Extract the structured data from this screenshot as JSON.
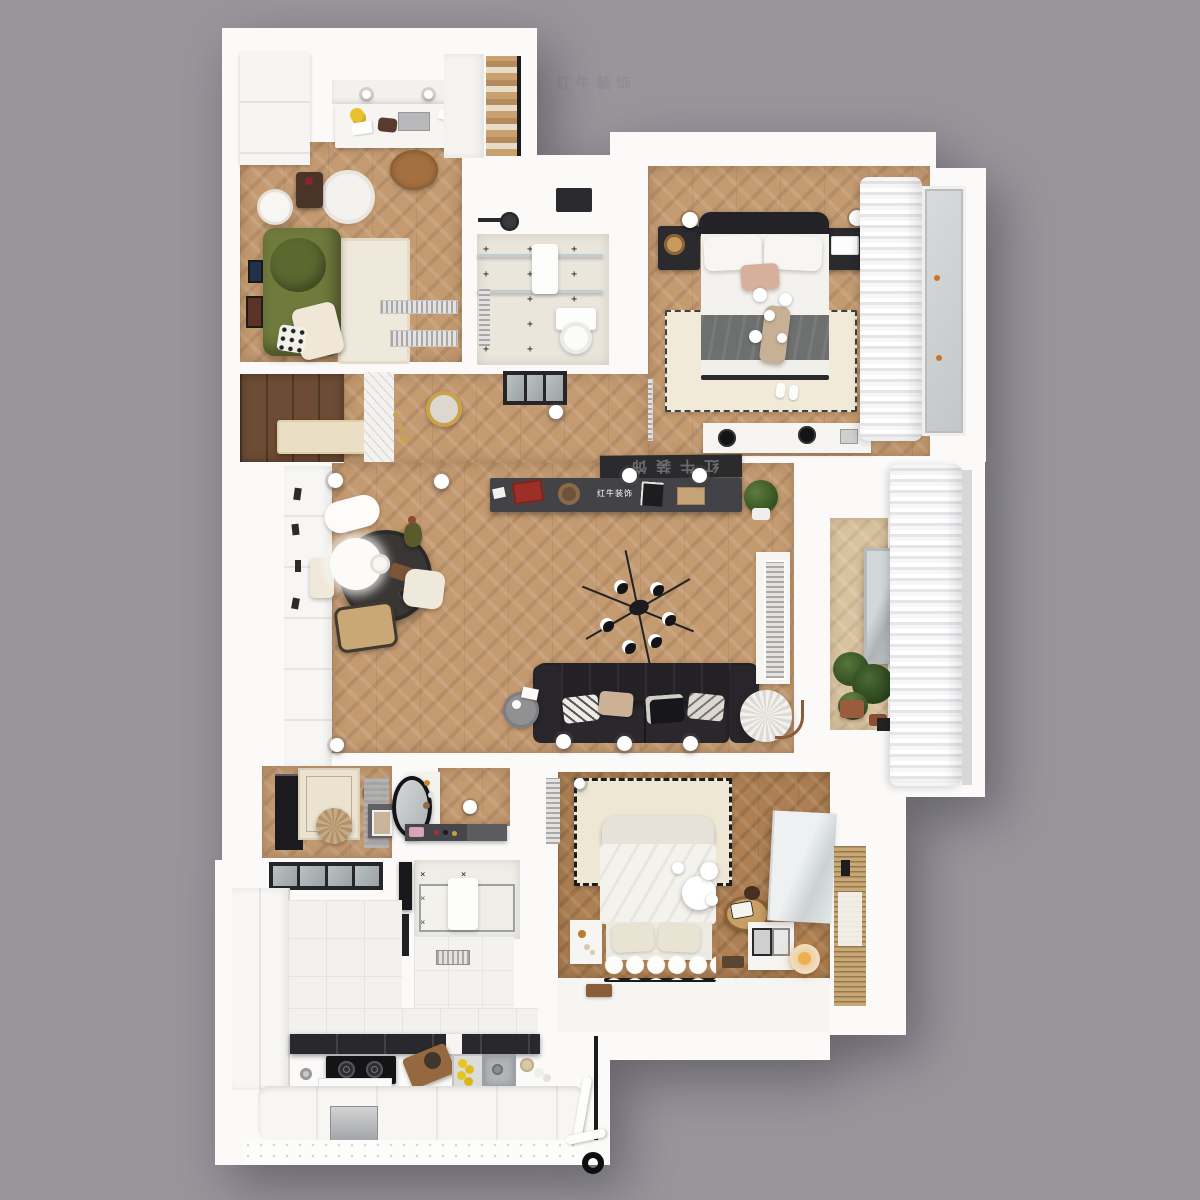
{
  "scene": {
    "background_color": "#98959b",
    "watermark_text": "红牛装饰",
    "view": "top-down 3d floorplan render"
  },
  "branding": {
    "console_logo_text": "红牛装饰",
    "screen_logo_text": "红牛装饰",
    "logo_color": "#ffffff"
  },
  "patterns": {
    "plus": "+",
    "cross": "×"
  },
  "palette": {
    "background": "#98959b",
    "wall_white": "#fbfaf9",
    "wood_mid": "#c49a70",
    "wood_light": "#d9c29e",
    "wood_dark": "#ad7f52",
    "plank_dark": "#6d4c35",
    "tile_cream": "#eae6dc",
    "tile_white": "#f3f2f0",
    "sofa_green": "#6f7a3c",
    "sofa_black": "#232126",
    "console_dark": "#434347",
    "accent_red": "#9c2f28",
    "lemon_yellow": "#e6c51e",
    "plant_green": "#4a6a33",
    "terracotta": "#9a5c3c",
    "brass_gold": "#c9a24a",
    "blanket_gray": "#6e706f",
    "pillow_pink": "#d6b09a"
  },
  "rooms": [
    {
      "id": "office",
      "label": "study room",
      "furniture": [
        "white wardrobe",
        "desk with laptop",
        "sunflowers",
        "leather desk chair",
        "round pouf table",
        "dark side table",
        "arc floor lamp",
        "green velvet sofa",
        "cream rug",
        "wall frames",
        "floor vents"
      ]
    },
    {
      "id": "closet",
      "label": "walk-in closet",
      "furniture": [
        "wood shelving",
        "white cabinet"
      ]
    },
    {
      "id": "bath-top",
      "label": "bathroom",
      "furniture": [
        "skylight",
        "shower head",
        "glass partition",
        "bath mat",
        "toilet",
        "plus-tile floor"
      ]
    },
    {
      "id": "bed-master",
      "label": "master bedroom",
      "furniture": [
        "black tufted bed",
        "white pillows",
        "pink pillow",
        "grey blanket",
        "pendant sphere lights",
        "black nightstands",
        "wall sphere lamps",
        "dotted cream rug",
        "slippers",
        "dresser with vinyl records",
        "sheer curtains",
        "balcony window"
      ]
    },
    {
      "id": "hallway",
      "label": "hallway",
      "furniture": [
        "cream chest",
        "floral wallpaper panel",
        "gold sunburst mirror",
        "brass candlesticks",
        "black glass door"
      ]
    },
    {
      "id": "living",
      "label": "living dining room",
      "furniture": [
        "white cabinet wall",
        "tv console",
        "projector screen",
        "plant",
        "sputnik chandelier",
        "round dining table",
        "sheepskin chair",
        "white chairs",
        "bentwood chair",
        "olive vase",
        "black leather sofa",
        "patterned pillows",
        "grey side table",
        "pleated floor lamp",
        "radiator grille column"
      ]
    },
    {
      "id": "balcony",
      "label": "balcony",
      "furniture": [
        "leaning mirror",
        "potted plants",
        "sheer curtains"
      ]
    },
    {
      "id": "entry",
      "label": "entry dressing area",
      "furniture": [
        "black bookshelf",
        "patterned rug",
        "jute pouf",
        "rattan tray",
        "grey runner mat",
        "art frame console",
        "glass sliding door"
      ]
    },
    {
      "id": "vanity",
      "label": "vanity room",
      "furniture": [
        "round black mirror",
        "white counter",
        "perfume bottles",
        "makeup console",
        "sphere light"
      ]
    },
    {
      "id": "bath-bottom",
      "label": "shower room",
      "furniture": [
        "cross-tile floor",
        "glass shower",
        "bath mat",
        "black shower column",
        "towel bar",
        "floor drain"
      ]
    },
    {
      "id": "bed-second",
      "label": "second bedroom",
      "furniture": [
        "white plush bed",
        "ruffled throw",
        "dashed-border rug",
        "pendant sphere cluster",
        "rattan chair",
        "white nightstand",
        "photo frames",
        "glowing sphere lamp",
        "mirror wardrobe",
        "wood blinds",
        "serving tray"
      ]
    },
    {
      "id": "kitchen",
      "label": "kitchen",
      "furniture": [
        "pantry columns",
        "white tile floor",
        "dark upper cabinets",
        "gas stove",
        "kettle",
        "cutting board with bread",
        "sink with lemons",
        "fluted lower cabinets",
        "steel appliance",
        "white pipe",
        "door knob"
      ]
    }
  ]
}
